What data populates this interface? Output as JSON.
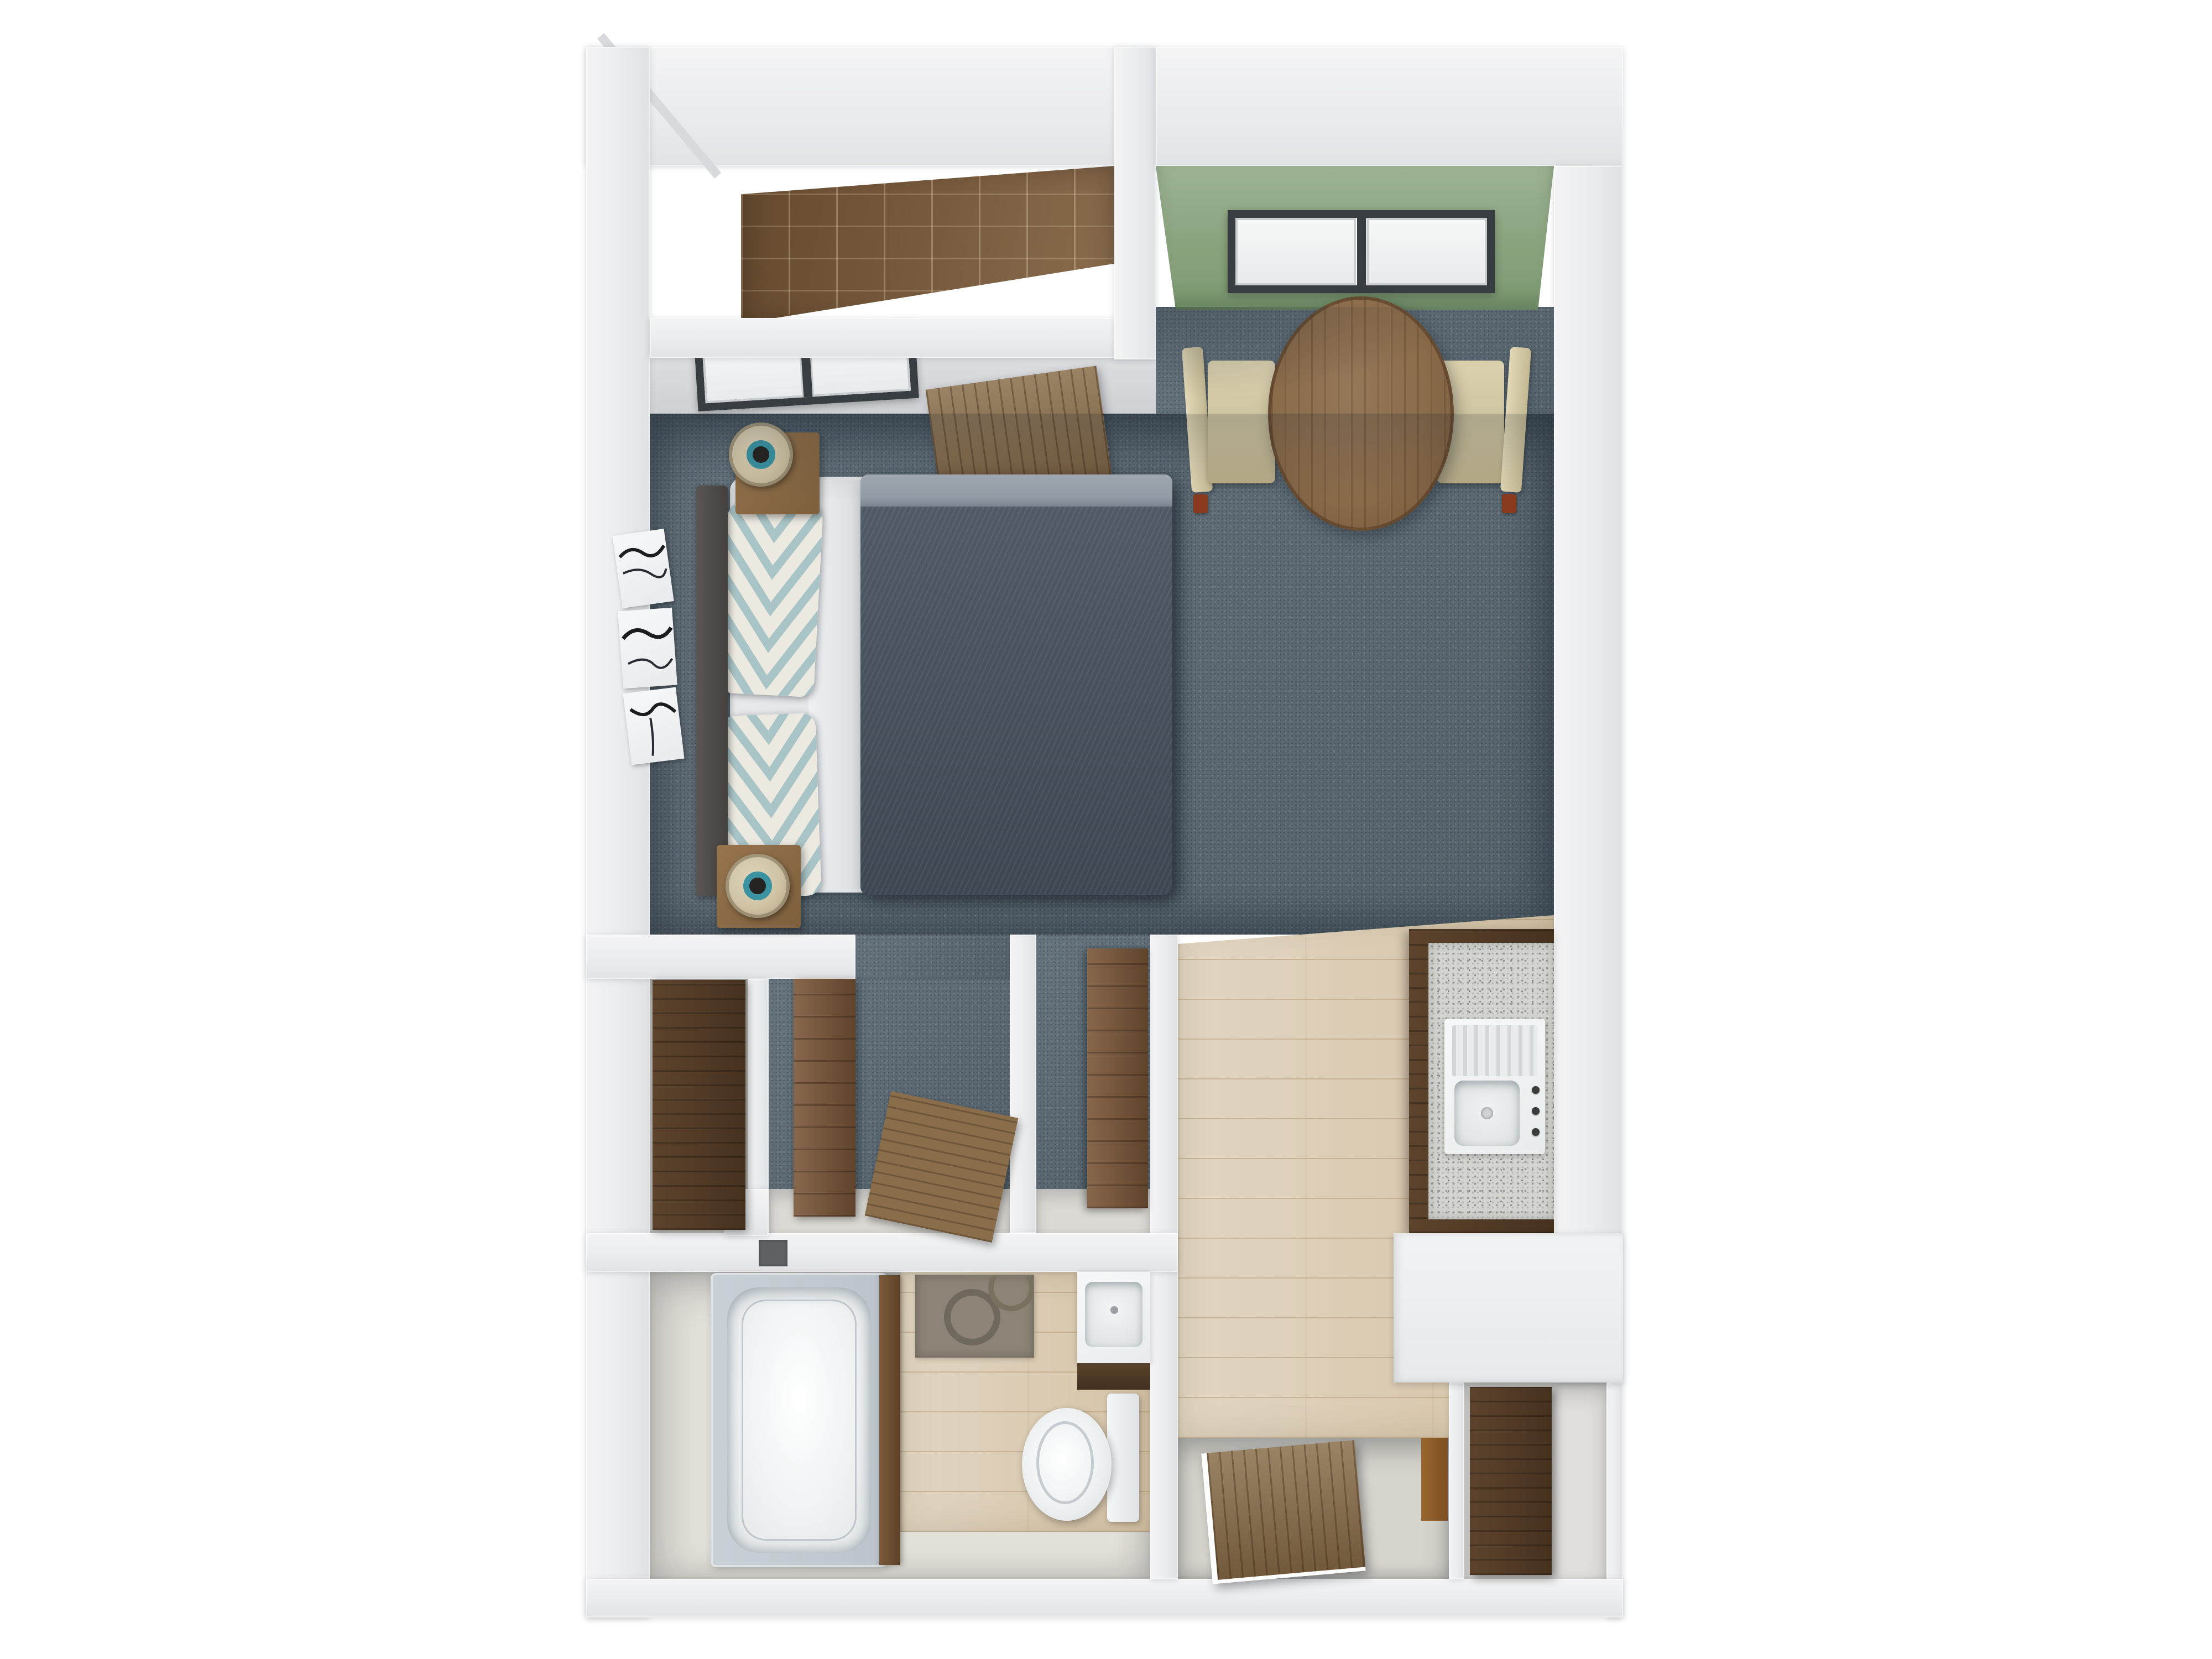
{
  "meta": {
    "title": "3D Floor Plan — Studio Apartment",
    "render_style": "top-down 3D architectural render",
    "visible_text": "none"
  },
  "palette": {
    "background": "#ffffff",
    "wall_white": "#ecedee",
    "wall_face_gray": "#d2d3d6",
    "carpet_blue_gray": "#5d6c76",
    "wood_floor_light": "#d9cab0",
    "tile_brown": "#7d5c3a",
    "accent_wall_green": "#8fa883",
    "granite_gray": "#d4d4d1",
    "fixture_white": "#f2f4f5",
    "wardrobe_dark_walnut": "#4a3423",
    "wardrobe_mid_walnut": "#7a5638",
    "duvet_dark_blue_gray": "#47525f",
    "sheet_fold_gray": "#9ca4ae",
    "pillow_teal": "#a9c4c6",
    "pillow_cream": "#ece9e1",
    "lamp_teal": "#3b93a1",
    "chair_beige": "#cdc29e",
    "chair_foot_rust": "#8a3a1c",
    "table_walnut": "#8a6b4a",
    "mat_taupe": "#8d8477",
    "door_wood": "#7b6244"
  },
  "rooms": [
    {
      "id": "storage-closet",
      "name": "Storage closet (brown tile floor)"
    },
    {
      "id": "sleeping-area",
      "name": "Sleeping area (blue-gray carpet)"
    },
    {
      "id": "dining-nook",
      "name": "Dining nook (green accent wall with window)"
    },
    {
      "id": "wardrobe-left",
      "name": "Wardrobe closet"
    },
    {
      "id": "wardrobe-middle",
      "name": "Walk-in closet"
    },
    {
      "id": "wardrobe-right",
      "name": "Linen closet"
    },
    {
      "id": "kitchen",
      "name": "Kitchenette (light wood floor)"
    },
    {
      "id": "bathroom",
      "name": "Bathroom"
    },
    {
      "id": "entry",
      "name": "Entry with open wood door"
    },
    {
      "id": "entry-closet",
      "name": "Entry closet with wardrobe"
    }
  ],
  "furniture": {
    "bed": "double bed, dark blue-gray duvet, light fold band",
    "pillows": "2 chevron pattern pillows (cream / pale teal)",
    "headboard": "dark gray headboard",
    "nightstands": "2 wood nightstands with drum lamps (teal ring center)",
    "wall_art": "triptych of white canvases with black abstract strokes",
    "dining_table": "round walnut table",
    "dining_chairs": "2 beige upholstered chairs with rust feet",
    "dining_window": "2-pane sliding window in green wall",
    "bedroom_window": "2-pane window on north wall",
    "bedroom_door_panel": "tilted wood door panel near dining opening",
    "kitchen_counter": "granite countertop with white sink, drainboard, 3 knobs",
    "kitchen_base": "white L-counter",
    "closet_board": "leaning wood board in walk-in closet",
    "bathtub": "white tub with gray surround",
    "toilet": "white toilet, tank to the right",
    "bath_vanity": "white sink with dark wood front",
    "bath_mat": "taupe mat with circle pattern",
    "entry_door": "open wood door lying over recessed threshold",
    "entry_wardrobe": "tall dark walnut wardrobe"
  }
}
